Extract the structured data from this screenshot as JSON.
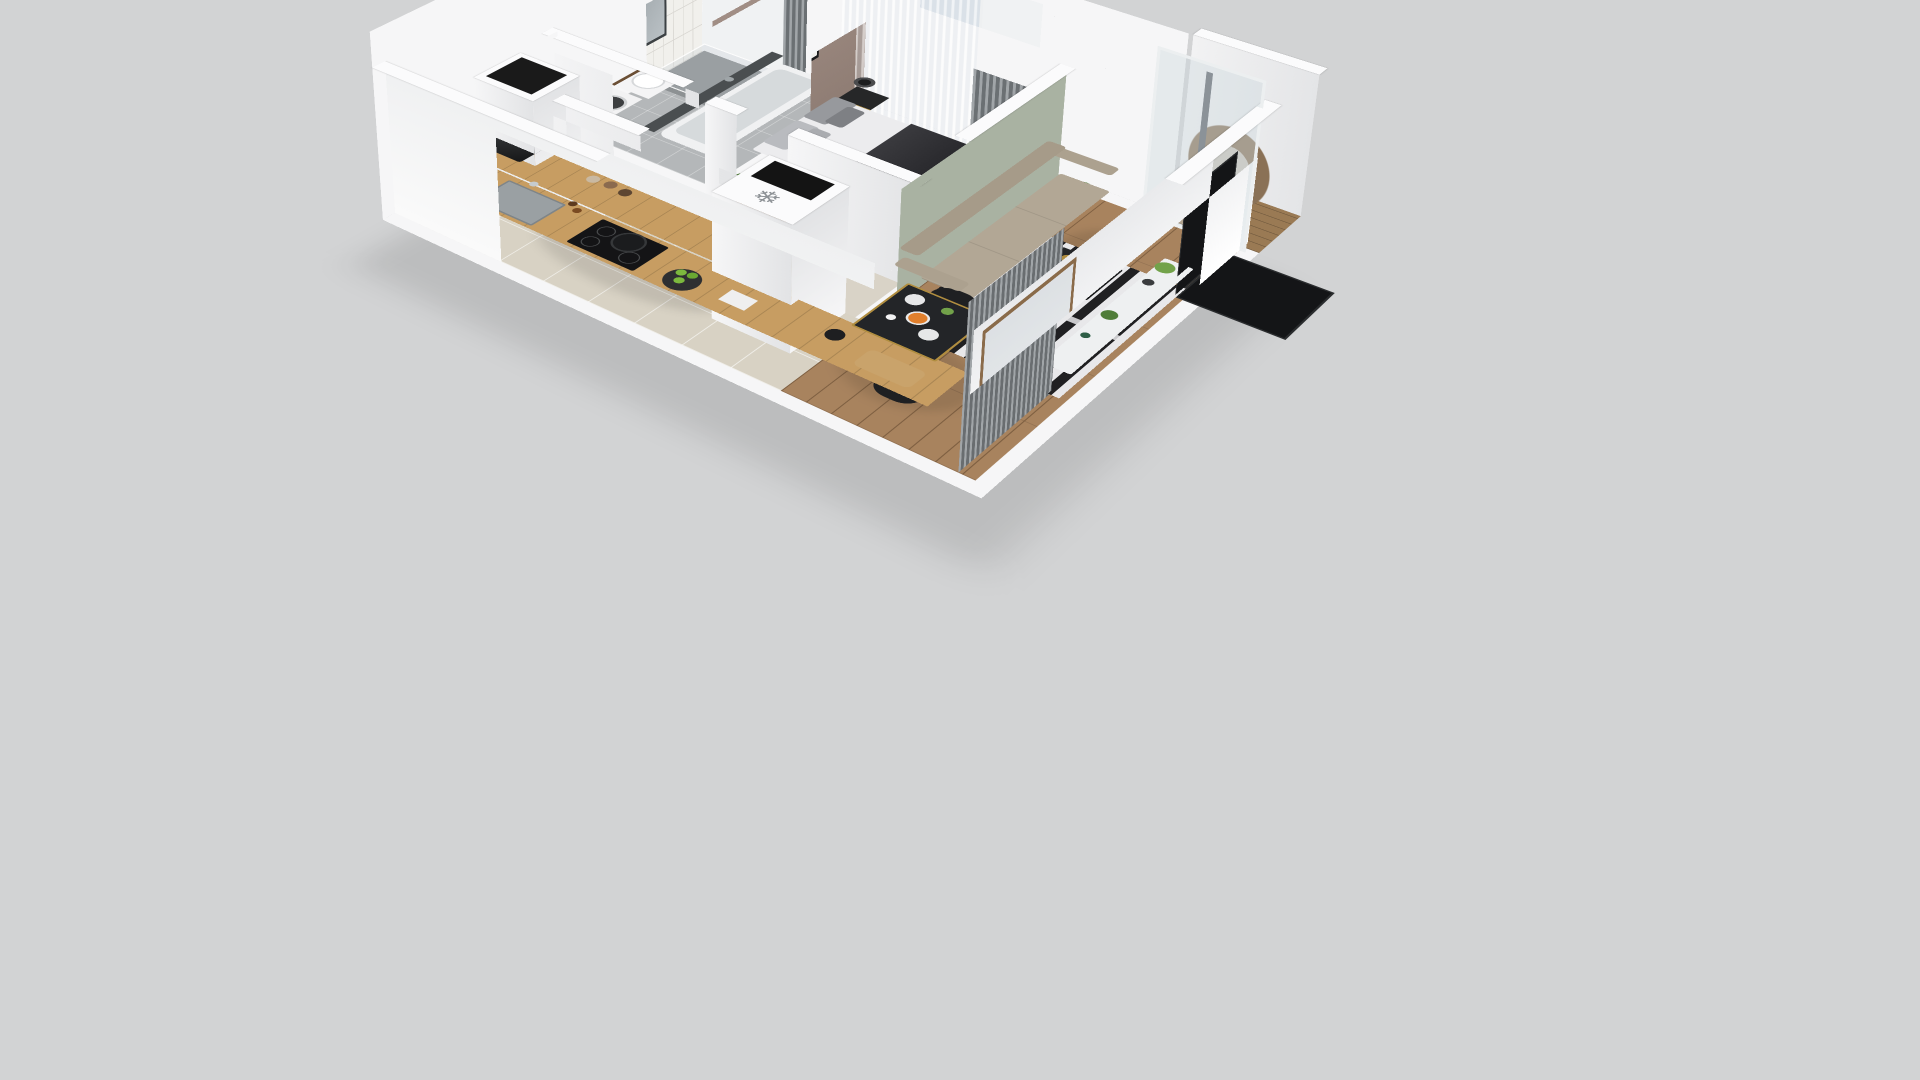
{
  "scene": {
    "type": "3d-isometric-floor-plan-render",
    "background": "#d2d3d4",
    "description": "Cutaway 3D floor plan of a one-bedroom apartment viewed from above at an angle"
  },
  "icons": {
    "snowflake": "❄"
  },
  "colors": {
    "bg": "#d2d3d4",
    "wall": "#f6f6f7",
    "wallShade": "#e2e3e5",
    "wallTop": "#fbfbfc",
    "tileWall": "#f1f0ec",
    "tileLine": "#d9d7d2",
    "taupe": "#a18e85",
    "taupeDark": "#8d7b72",
    "darkTile": "#4a4e50",
    "sage": "#a9b2a2",
    "woodFloor": "#a8835e",
    "woodLine": "#7e5f41",
    "kitchenCounter": "#c79d62",
    "kitchenTile": "#d8d2c4",
    "hallFloor": "#d9d3c7",
    "bathFloor": "#b4b7b9",
    "rugBlack": "#202022",
    "rugWhite": "#e8e8ea",
    "sofa": "#b2a795",
    "sofaDark": "#a297855",
    "curtain": "#868c90",
    "sheer": "#cdd4d9",
    "glass": "#c3ccd2",
    "dark": "#1d1e20",
    "tv": "#141517",
    "deck": "#9a7a54",
    "rattan": "#8a7156",
    "cushion": "#c9c2b8",
    "plant": "#4f7d38",
    "plantLight": "#72a24a",
    "orange": "#e07f2c",
    "apple": "#7cb93e",
    "gold": "#b08d3f",
    "bedWhite": "#ececee",
    "throw": "#2a2a2e",
    "pillow": "#97999d",
    "bench": "#8f9295",
    "steel": "#9aa0a3",
    "mirror": "#a7aeb2",
    "woodDark": "#6b4f35"
  },
  "rooms": [
    {
      "name": "bathroom",
      "floor": "gray tile",
      "furniture": [
        "shower",
        "mirror",
        "sink-vanity",
        "washing-machine",
        "bathtub"
      ]
    },
    {
      "name": "bedroom",
      "floor": "wood",
      "furniture": [
        "double-bed",
        "nightstand",
        "table-lamp",
        "wall-art",
        "foot-bench",
        "open-wardrobe",
        "plant"
      ]
    },
    {
      "name": "living-room",
      "floor": "wood",
      "furniture": [
        "sofa",
        "coffee-table",
        "striped-rug",
        "sideboard",
        "tv",
        "curtains",
        "sliding-glass-door",
        "plants"
      ]
    },
    {
      "name": "kitchen",
      "floor": "beige tile",
      "furniture": [
        "counter",
        "sink",
        "induction-hob",
        "coffee-machine",
        "fridge",
        "apple-plate",
        "cutting-board"
      ]
    },
    {
      "name": "dining",
      "floor": "wood",
      "furniture": [
        "dining-table",
        "chair",
        "chair",
        "chair",
        "orange-bowl",
        "plates"
      ]
    },
    {
      "name": "balcony",
      "floor": "deck wood",
      "furniture": [
        "hanging-bubble-chair",
        "parapet"
      ]
    },
    {
      "name": "hallway",
      "floor": "light wood",
      "furniture": [
        "vent-shaft"
      ]
    }
  ]
}
